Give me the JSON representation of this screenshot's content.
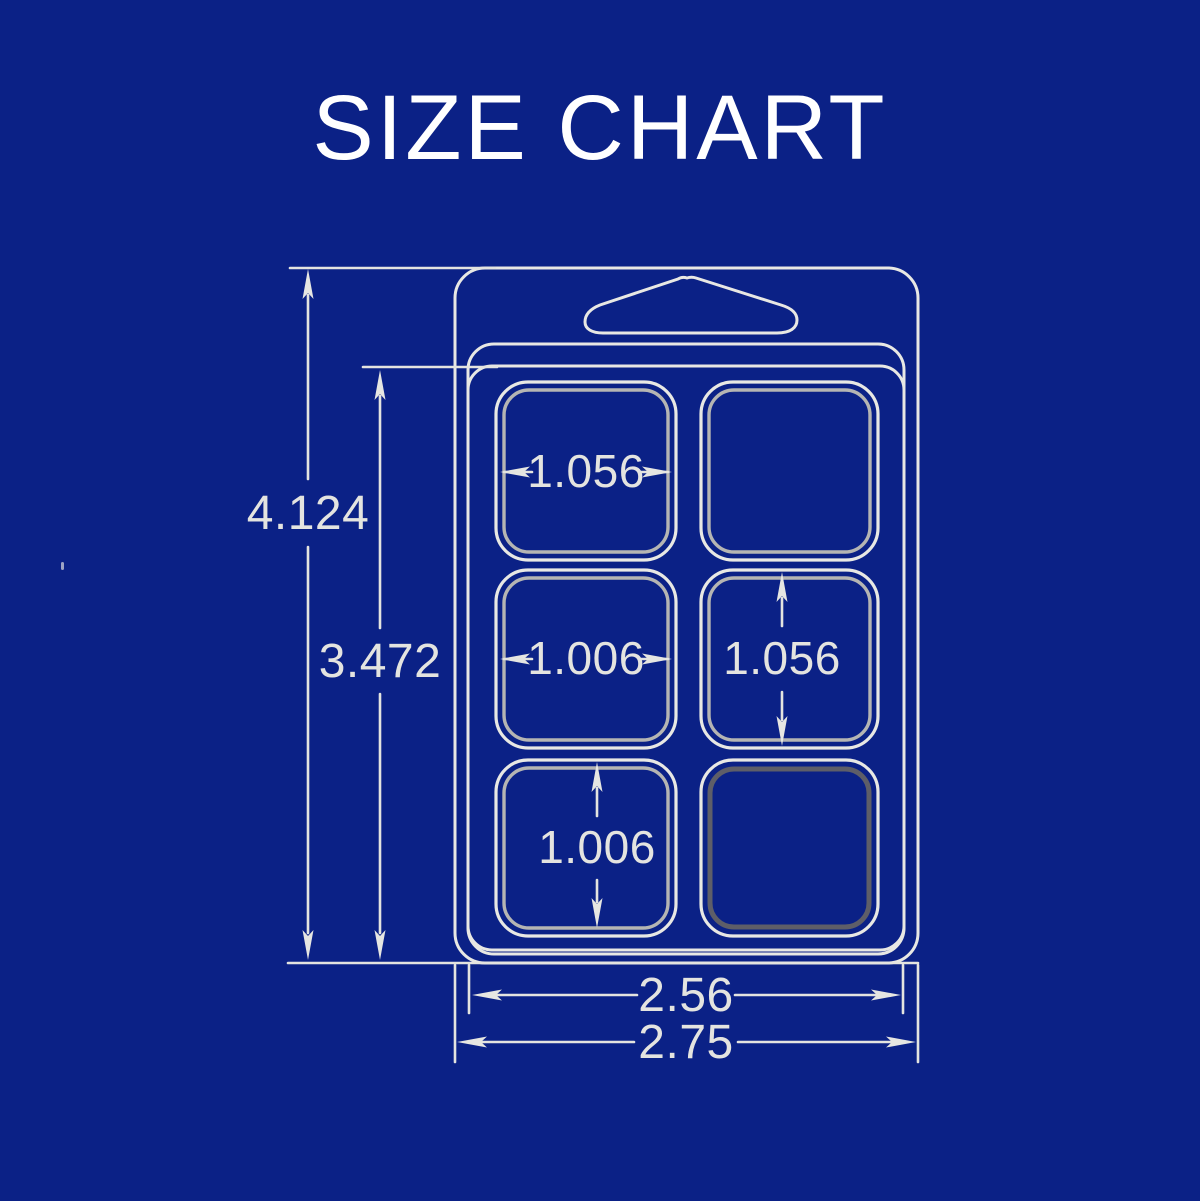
{
  "page": {
    "title": "SIZE CHART",
    "background_color": "#0B2186",
    "line_color": "#E8E8E4",
    "title_color": "#FFFFFF"
  },
  "drawing": {
    "type": "blister-pack-size-diagram",
    "cavity_grid": {
      "rows": 3,
      "columns": 2
    },
    "dimensions": {
      "overall_height": "4.124",
      "tray_height": "3.472",
      "top_left_cavity_width": "1.056",
      "middle_left_cavity_width": "1.006",
      "middle_right_cavity_height": "1.056",
      "bottom_left_cavity_height": "1.006",
      "tray_width": "2.56",
      "overall_width": "2.75"
    }
  }
}
